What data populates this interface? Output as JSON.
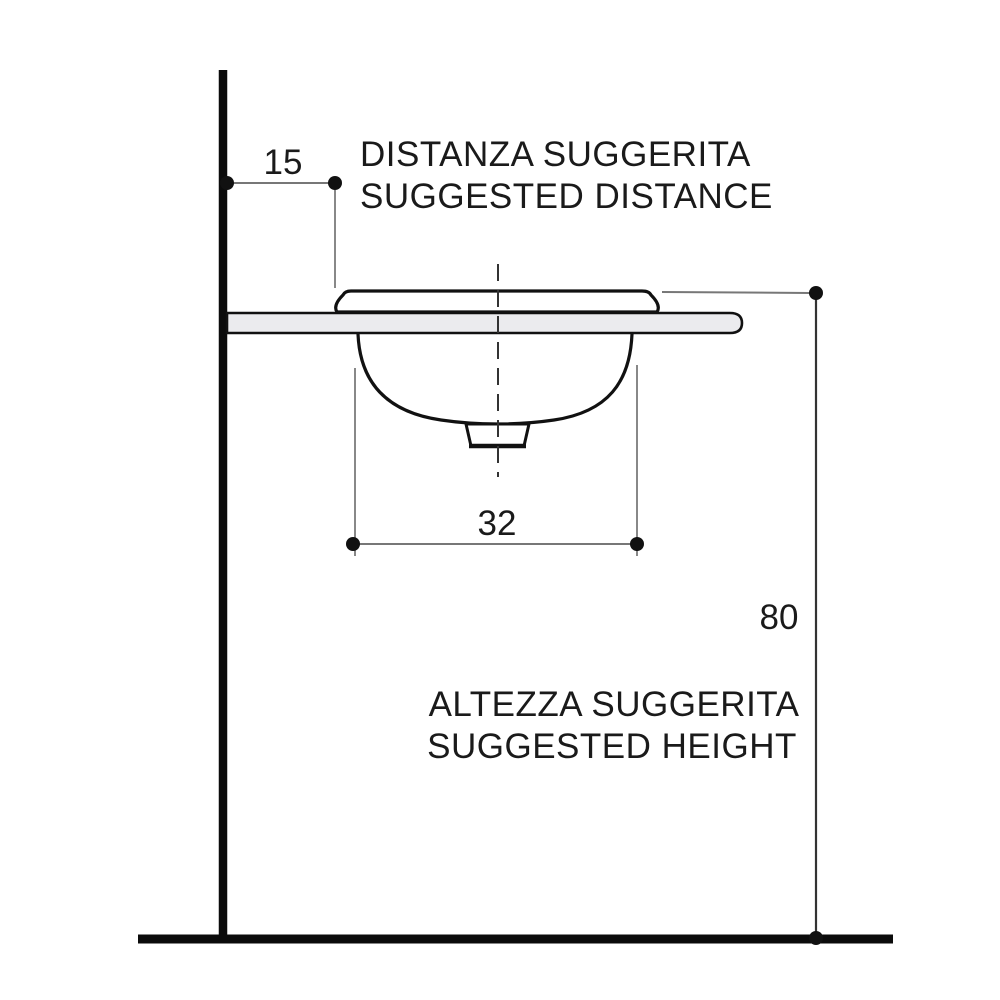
{
  "diagram": {
    "type": "installation-drawing",
    "subject": "inset washbasin side view with suggested mounting dimensions",
    "annotations": {
      "distance": {
        "value": "15",
        "label_line1": "DISTANZA SUGGERITA",
        "label_line2": "SUGGESTED DISTANCE"
      },
      "basin_width": {
        "value": "32"
      },
      "height": {
        "value": "80",
        "label_line1": "ALTEZZA SUGGERITA",
        "label_line2": "SUGGESTED HEIGHT"
      }
    },
    "colors": {
      "background": "#ffffff",
      "outline": "#111111",
      "structure": "#0b0b0b",
      "dimension_line": "#777777",
      "extension_line": "#888888",
      "centerline": "#333333",
      "counter_fill": "#ebebee",
      "text": "#1a1a1a"
    }
  }
}
